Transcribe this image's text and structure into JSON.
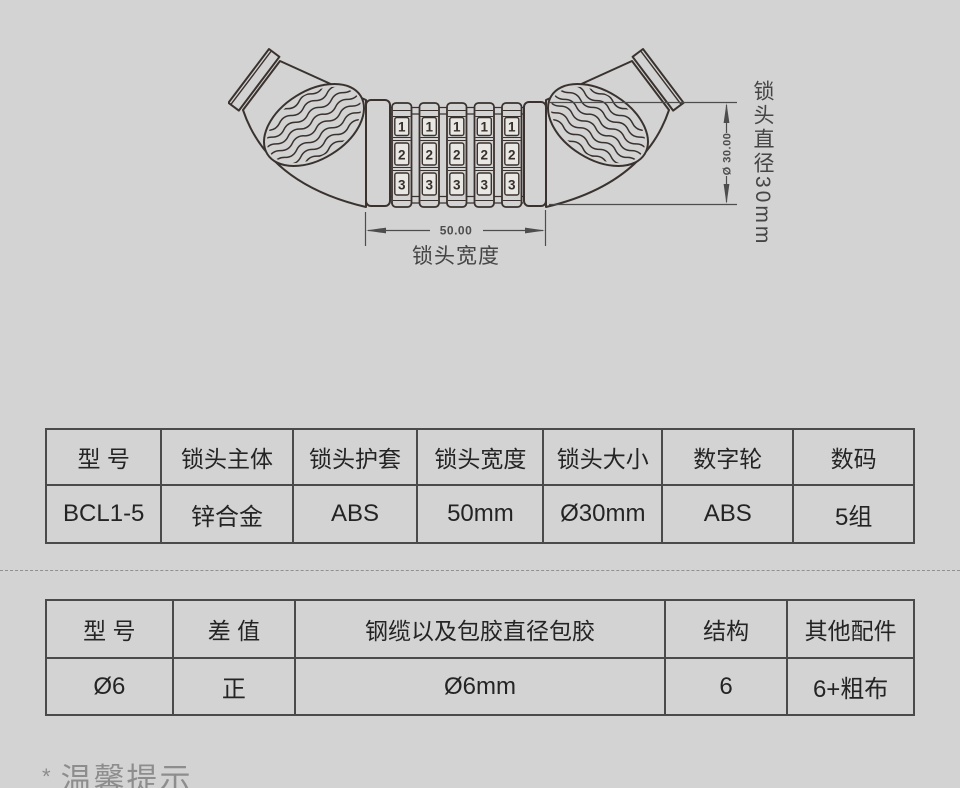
{
  "page": {
    "background_color": "#d3d3d3"
  },
  "lock_drawing": {
    "dial_count": 5,
    "dial_digits": [
      "1",
      "2",
      "3"
    ],
    "width_dim": {
      "value": "50.00",
      "label": "锁头宽度"
    },
    "diameter_dim": {
      "value": "Ø 30.00",
      "label": "锁头直径30mm"
    },
    "colors": {
      "outline": "#3a322e",
      "dimension": "#4d4d4d",
      "window_fill": "#e9e7e4"
    }
  },
  "spec_table_1": {
    "headers": [
      "型 号",
      "锁头主体",
      "锁头护套",
      "锁头宽度",
      "锁头大小",
      "数字轮",
      "数码"
    ],
    "row": [
      "BCL1-5",
      "锌合金",
      "ABS",
      "50mm",
      "Ø30mm",
      "ABS",
      "5组"
    ]
  },
  "spec_table_2": {
    "headers": [
      "型 号",
      "差 值",
      "钢缆以及包胶直径包胶",
      "结构",
      "其他配件"
    ],
    "row": [
      "Ø6",
      "正",
      "Ø6mm",
      "6",
      "6+粗布"
    ]
  },
  "footer": {
    "marker": "*",
    "note": "温馨提示"
  },
  "table_style": {
    "border_color": "#4a4a4a",
    "text_color": "#242424"
  }
}
